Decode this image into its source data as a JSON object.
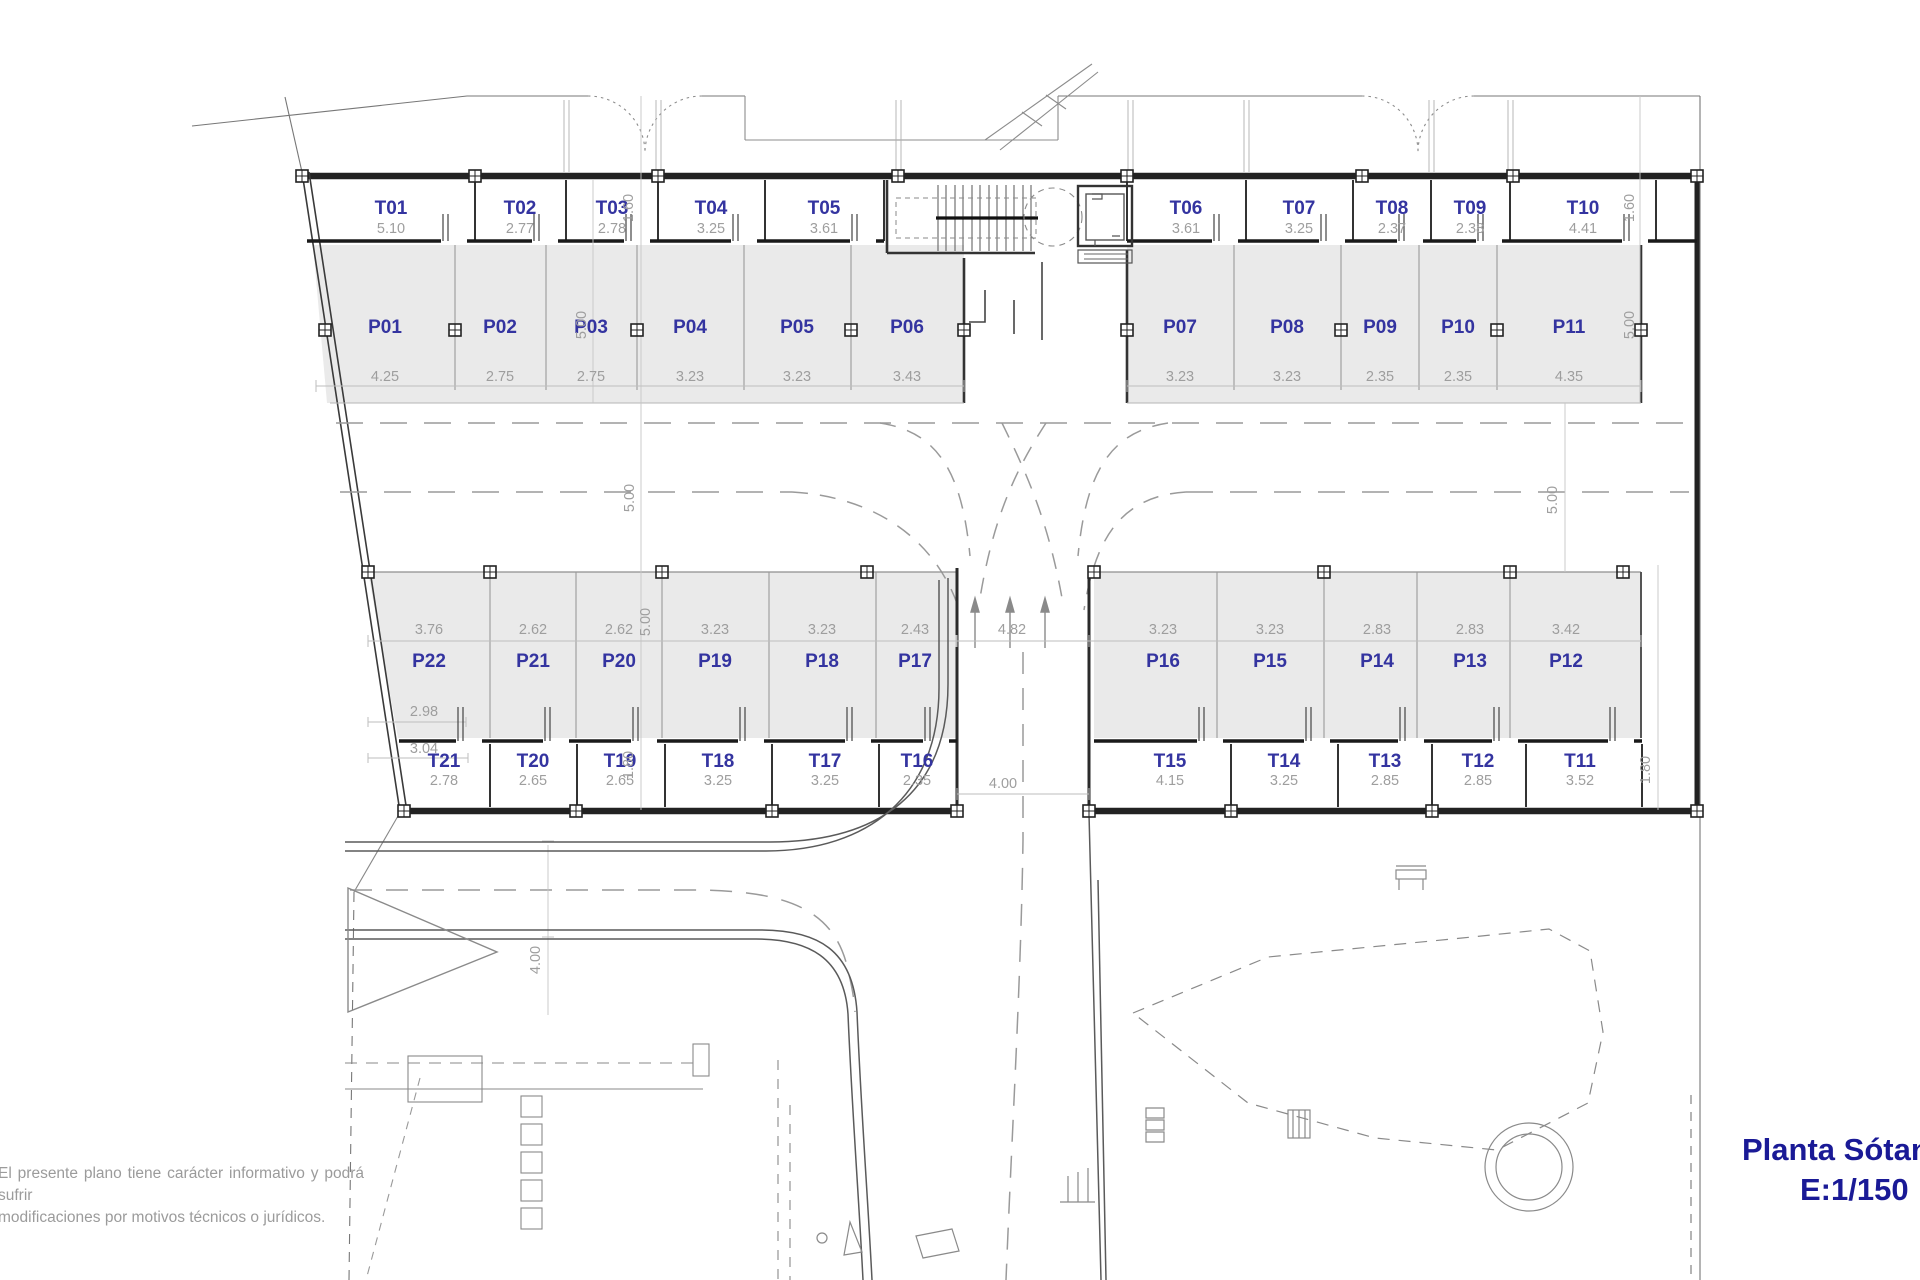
{
  "title": {
    "name": "Planta Sótano",
    "scale": "E:1/150"
  },
  "disclaimer": {
    "line1": "El presente plano tiene carácter informativo y podrá sufrir",
    "line2": "modificaciones por motivos técnicos o jurídicos."
  },
  "colors": {
    "label_blue": "#3434a0",
    "dim_gray": "#9e9e9e",
    "title_blue": "#1a1a96",
    "stall_fill": "#eaeaea"
  },
  "storage_top": [
    {
      "code": "T01",
      "width": "5.10"
    },
    {
      "code": "T02",
      "width": "2.77"
    },
    {
      "code": "T03",
      "width": "2.78"
    },
    {
      "code": "T04",
      "width": "3.25"
    },
    {
      "code": "T05",
      "width": "3.61"
    },
    {
      "code": "T06",
      "width": "3.61"
    },
    {
      "code": "T07",
      "width": "3.25"
    },
    {
      "code": "T08",
      "width": "2.37"
    },
    {
      "code": "T09",
      "width": "2.38"
    },
    {
      "code": "T10",
      "width": "4.41"
    }
  ],
  "parking_top": [
    {
      "code": "P01",
      "width": "4.25"
    },
    {
      "code": "P02",
      "width": "2.75"
    },
    {
      "code": "P03",
      "width": "2.75"
    },
    {
      "code": "P04",
      "width": "3.23"
    },
    {
      "code": "P05",
      "width": "3.23"
    },
    {
      "code": "P06",
      "width": "3.43"
    },
    {
      "code": "P07",
      "width": "3.23"
    },
    {
      "code": "P08",
      "width": "3.23"
    },
    {
      "code": "P09",
      "width": "2.35"
    },
    {
      "code": "P10",
      "width": "2.35"
    },
    {
      "code": "P11",
      "width": "4.35"
    }
  ],
  "parking_bottom": [
    {
      "code": "P22",
      "width": "3.76"
    },
    {
      "code": "P21",
      "width": "2.62"
    },
    {
      "code": "P20",
      "width": "2.62"
    },
    {
      "code": "P19",
      "width": "3.23"
    },
    {
      "code": "P18",
      "width": "3.23"
    },
    {
      "code": "P17",
      "width": "2.43"
    },
    {
      "code": "P16",
      "width": "3.23"
    },
    {
      "code": "P15",
      "width": "3.23"
    },
    {
      "code": "P14",
      "width": "2.83"
    },
    {
      "code": "P13",
      "width": "2.83"
    },
    {
      "code": "P12",
      "width": "3.42"
    }
  ],
  "storage_bottom": [
    {
      "code": "T21",
      "width": "2.78"
    },
    {
      "code": "T20",
      "width": "2.65"
    },
    {
      "code": "T19",
      "width": "2.65"
    },
    {
      "code": "T18",
      "width": "3.25"
    },
    {
      "code": "T17",
      "width": "3.25"
    },
    {
      "code": "T16",
      "width": "2.35"
    },
    {
      "code": "T15",
      "width": "4.15"
    },
    {
      "code": "T14",
      "width": "3.25"
    },
    {
      "code": "T13",
      "width": "2.85"
    },
    {
      "code": "T12",
      "width": "2.85"
    },
    {
      "code": "T11",
      "width": "3.52"
    }
  ],
  "dims": {
    "v160_left": "1.60",
    "bay_left": "5.00",
    "aisle_left": "5.00",
    "stall_bl": "5.00",
    "v180_left": "1.80",
    "v160_right": "1.60",
    "bay_right": "5.00",
    "aisle_right": "5.00",
    "v180_right": "1.80",
    "junction": "4.82",
    "ramp": "4.00",
    "road": "4.00",
    "p22_a": "2.98",
    "p22_b": "3.04"
  }
}
